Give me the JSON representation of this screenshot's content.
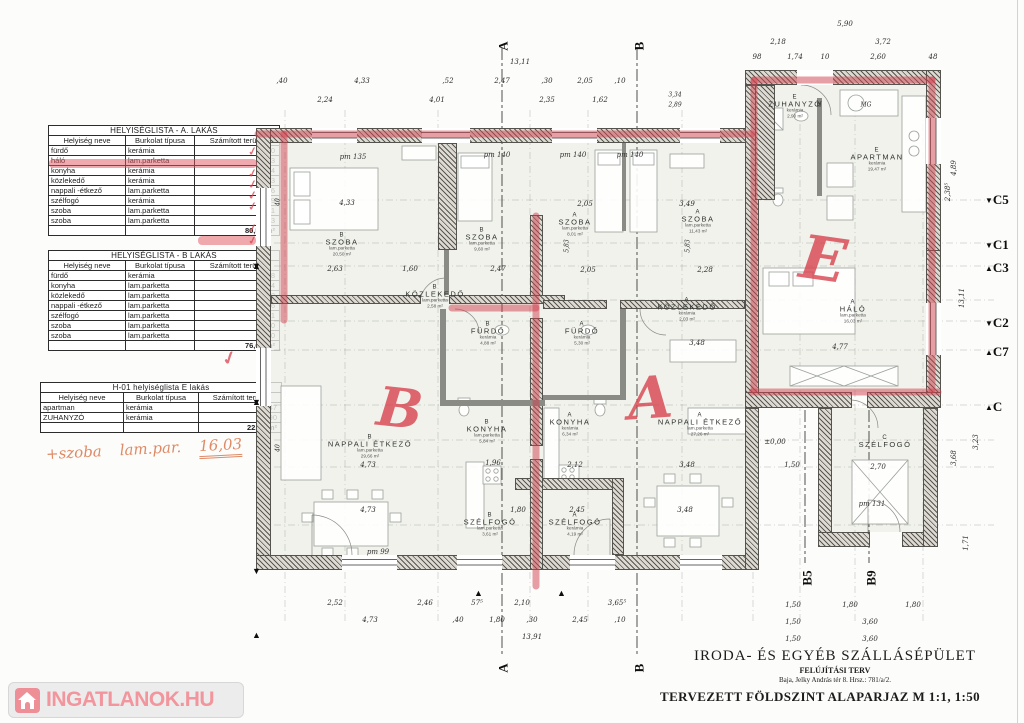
{
  "tables": [
    {
      "id": "a",
      "title": "HELYISÉGLISTA - A. LAKÁS",
      "headers": [
        "Helyiség neve",
        "Burkolat típusa",
        "Számított terület"
      ],
      "rows": [
        [
          "fürdő",
          "kerámia",
          "5,30"
        ],
        [
          "háló",
          "lam.parketta",
          "16,03"
        ],
        [
          "konyha",
          "kerámia",
          "6,34"
        ],
        [
          "közlekedő",
          "kerámia",
          "2,03"
        ],
        [
          "nappali -étkező",
          "lam.parketta",
          "27,26"
        ],
        [
          "szélfogó",
          "kerámia",
          "4,19"
        ],
        [
          "szoba",
          "lam.parketta",
          "8,01"
        ],
        [
          "szoba",
          "lam.parketta",
          "11,43"
        ]
      ],
      "total": "80,59 m²"
    },
    {
      "id": "b",
      "title": "HELYISÉGLISTA - B LAKÁS",
      "headers": [
        "Helyiség neve",
        "Burkolat típusa",
        "Számított terület"
      ],
      "rows": [
        [
          "fürdő",
          "kerámia",
          "4,88"
        ],
        [
          "konyha",
          "lam.parketta",
          "5,84"
        ],
        [
          "közlekedő",
          "lam.parketta",
          "2,58"
        ],
        [
          "nappali -étkező",
          "lam.parketta",
          "29,66"
        ],
        [
          "szélfogó",
          "lam.parketta",
          "3,61"
        ],
        [
          "szoba",
          "lam.parketta",
          "9,60"
        ],
        [
          "szoba",
          "lam.parketta",
          "20,50"
        ]
      ],
      "total": "76,67 m²"
    },
    {
      "id": "e",
      "title": "H-01 helyiséglista E lakás",
      "headers": [
        "Helyiség neve",
        "Burkolat típusa",
        "Számított terület"
      ],
      "rows": [
        [
          "apartman",
          "kerámia",
          "19,47"
        ],
        [
          "ZUHANYZÓ",
          "kerámia",
          "2,90"
        ]
      ],
      "total": "22,37 m²"
    }
  ],
  "handwritten": {
    "prefix": "+szoba",
    "middle": "lam.par.",
    "value": "16,03",
    "marker_letters": [
      "B",
      "A",
      "E"
    ]
  },
  "plan": {
    "rooms": [
      {
        "id": "b-szoba-1",
        "letter": "B",
        "name": "SZOBA",
        "material": "lam.parketta",
        "area": "20,50 m²"
      },
      {
        "id": "b-szoba-2",
        "letter": "B",
        "name": "SZOBA",
        "material": "lam.parketta",
        "area": "9,60 m²"
      },
      {
        "id": "a-szoba-1",
        "letter": "A",
        "name": "SZOBA",
        "material": "lam.parketta",
        "area": "8,01 m²"
      },
      {
        "id": "a-szoba-2",
        "letter": "A",
        "name": "SZOBA",
        "material": "lam.parketta",
        "area": "11,43 m²"
      },
      {
        "id": "e-zuhanyzo",
        "letter": "E",
        "name": "ZUHANYZÓ",
        "material": "kerámia",
        "area": "2,90 m²"
      },
      {
        "id": "e-apartman",
        "letter": "E",
        "name": "APARTMAN",
        "material": "kerámia",
        "area": "19,47 m²"
      },
      {
        "id": "b-kozlekedo",
        "letter": "B",
        "name": "KÖZLEKEDŐ",
        "material": "lam.parketta",
        "area": "2,58 m²"
      },
      {
        "id": "a-kozlekedo",
        "letter": "A",
        "name": "KÖZLEKEDŐ",
        "material": "kerámia",
        "area": "2,03 m²"
      },
      {
        "id": "b-furdo",
        "letter": "B",
        "name": "FÜRDŐ",
        "material": "kerámia",
        "area": "4,88 m²"
      },
      {
        "id": "a-furdo",
        "letter": "A",
        "name": "FÜRDŐ",
        "material": "kerámia",
        "area": "5,30 m²"
      },
      {
        "id": "halo",
        "letter": "A",
        "name": "HÁLÓ",
        "material": "lam.parketta",
        "area": "16,03 m²"
      },
      {
        "id": "b-nappali",
        "letter": "B",
        "name": "NAPPALI ÉTKEZŐ",
        "material": "lam.parketta",
        "area": "29,66 m²"
      },
      {
        "id": "a-nappali",
        "letter": "A",
        "name": "NAPPALI ÉTKEZŐ",
        "material": "lam.parketta",
        "area": "27,26 m²"
      },
      {
        "id": "b-konyha",
        "letter": "B",
        "name": "KONYHA",
        "material": "lam.parketta",
        "area": "5,84 m²"
      },
      {
        "id": "a-konyha",
        "letter": "A",
        "name": "KONYHA",
        "material": "kerámia",
        "area": "6,34 m²"
      },
      {
        "id": "b-szelfogo",
        "letter": "B",
        "name": "SZÉLFOGÓ",
        "material": "lam.parketta",
        "area": "3,61 m²"
      },
      {
        "id": "a-szelfogo",
        "letter": "A",
        "name": "SZÉLFOGÓ",
        "material": "kerámia",
        "area": "4,19 m²"
      },
      {
        "id": "c-szelfogo",
        "letter": "C",
        "name": "SZÉLFOGÓ",
        "material": "",
        "area": ""
      }
    ],
    "dims": {
      "top_total": "13,11",
      "top_row1": [
        ",40",
        "4,33",
        ",52",
        "2,47",
        ",30",
        "2,05",
        ",10"
      ],
      "top_row2": [
        "2,24",
        "4,01",
        "2,35",
        "1,62"
      ],
      "e_total": "5,90",
      "e_row1": [
        "2,18",
        "3,72"
      ],
      "e_row2": [
        "98",
        "1,74",
        "10",
        "2,60",
        "48"
      ],
      "left_pair": [
        "3,34",
        "2,89"
      ],
      "right_col": [
        "4,89",
        "2,38⁵",
        "13,11",
        "3,23",
        "3,68",
        "1,71"
      ],
      "bottom_row1": [
        "2,52",
        "2,46",
        "57⁵",
        "2,10",
        "3,65⁵"
      ],
      "bottom_row2": [
        "4,73",
        ",40",
        "1,80",
        ",30",
        "2,45",
        ",10"
      ],
      "bottom_total": "13,91",
      "br_row1": [
        "1,50",
        "1,80",
        "1,80"
      ],
      "br_row2": [
        "1,50",
        "3,60"
      ],
      "br_row3": [
        "1,50",
        "3,60"
      ],
      "inner": [
        "4,33",
        "2,63",
        "1,60",
        "2,47",
        "2,05",
        "2,28",
        "2,05",
        "3,49",
        "3,48",
        "4,77",
        "1,96",
        "2,12",
        "3,48",
        "4,73",
        "4,73",
        "1,80",
        "2,45",
        "3,48",
        "1,50",
        "2,70"
      ],
      "inner_rot": [
        "5,83",
        "5,83",
        "40",
        "40"
      ],
      "app_labels": [
        "H",
        "MG"
      ]
    },
    "pm_labels": [
      "pm 135",
      "pm 140",
      "pm 140",
      "pm 140",
      "pm 99",
      "pm 131"
    ],
    "level_marker": "±0,00",
    "grid_markers": [
      {
        "label": "C5",
        "arrow": "▼"
      },
      {
        "label": "C1",
        "arrow": "▼"
      },
      {
        "label": "C3",
        "arrow": "▲"
      },
      {
        "label": "C2",
        "arrow": "▼"
      },
      {
        "label": "C7",
        "arrow": "▲"
      },
      {
        "label": "C",
        "arrow": "▲"
      }
    ],
    "section_markers": {
      "top": [
        "A",
        "B"
      ],
      "bottom": [
        "A",
        "B"
      ],
      "side": [
        "B5",
        "B9"
      ]
    }
  },
  "title_block": {
    "line1": "IRODA- ÉS EGYÉB SZÁLLÁSÉPÜLET",
    "line2": "FELÚJÍTÁSI TERV",
    "line3": "Baja, Jelky András tér 8.   Hrsz.: 781/a/2.",
    "line4": "TERVEZETT FÖLDSZINT ALAPARJAZ   M 1:1, 1:50"
  },
  "branding": {
    "logo_text": "INGATLANOK.HU"
  }
}
